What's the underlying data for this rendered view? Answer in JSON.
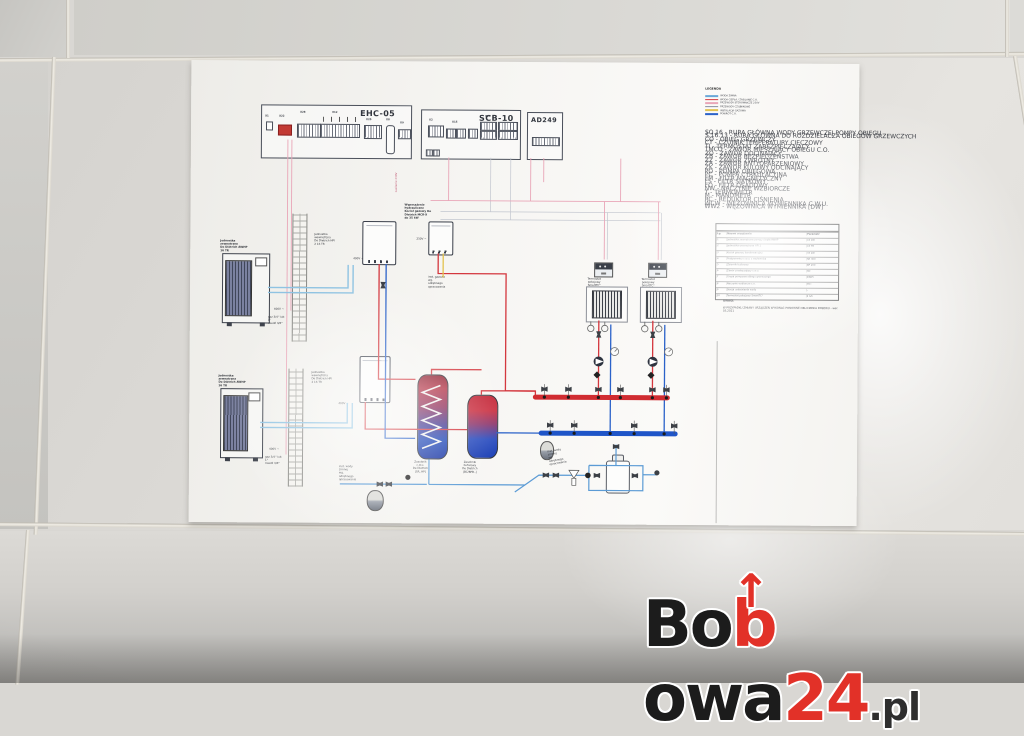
{
  "watermark": {
    "bo": "Bo",
    "b_arrow": "b",
    "arrow": "↑",
    "owa": "owa",
    "num": "24",
    "tld": ".pl"
  },
  "colors": {
    "logo_black": "#1c1c1c",
    "logo_red": "#e23128",
    "paper": "#f6f5f2",
    "tile": "#d9d7d3",
    "pipe_hot": "#d4373e",
    "pipe_cold": "#2b62c9",
    "pipe_refrigerant": "#8fc3e2",
    "wire_control": "#e9a6b8",
    "gas_line": "#e3c24f",
    "manifold_hot": "#d02c31",
    "manifold_cold": "#1f55c8"
  },
  "boards": {
    "ehc": {
      "title": "EHC-05",
      "x1": "X1",
      "x22": "X22",
      "x28": "X28",
      "x12": "X12",
      "x25": "X25",
      "x8": "X8",
      "x9": "X9"
    },
    "scb": {
      "title": "SCB-10",
      "x2": "X2",
      "x15": "X15",
      "x14": "X14"
    },
    "ad": {
      "title": "AD249"
    }
  },
  "devices": {
    "outdoor1": "Jednostka zewnętrzna\nDe Dietrich AWHP 16 TR",
    "outdoor2": "Jednostka zewnętrzna\nDe Dietrich AWHP 16 TR",
    "indoor1": "Jednostka wewnętrzna\nDe Dietrich HPI 2 16 TR",
    "indoor2": "Jednostka wewnętrzna\nDe Dietrich HPI 2 16 TR",
    "boiler": "Wyposażenie hydrauliczne\nKocioł gazowy De Dietrich MCR-X\ndo 35 kW",
    "dhw_tank": "Zasobnik c.w.u.\nDe Dietrich [SR..HP]",
    "buffer_tank": "Zasobnik buforowy\nDe Dietrich [BC/BPB..]",
    "thermostat1": "Termostat pokojowy\nSmartTC°",
    "thermostat2": "Termostat pokojowy\nSmartTC°",
    "v400": "400V ~",
    "v230": "230V ~",
    "gas_note": "inst. gazowa\nwg. odrębnego\nopracowania",
    "cold_note": "inst. wody zimnej\nwg. odrębnego\nopracowania",
    "pipe_note": "gaz 3/4'' lub 1''\nmiedź 3/8''",
    "power_note": "zasilanie 230V"
  },
  "legend": {
    "title": "LEGENDA",
    "keys": [
      {
        "css": "background:#6aa8d8",
        "label": "WODA ZIMNA"
      },
      {
        "css": "background:#d4373e",
        "label": "WODA CIEPŁA / ZASILANIE C.O."
      },
      {
        "css": "background:#e9a6b8",
        "label": "PRZEWODY STEROWNICZE 230V"
      },
      {
        "css": "background:#8a8fa0",
        "label": "PRZEWODY CZUJNIKOWE"
      },
      {
        "css": "background:#e3c24f",
        "label": "INSTALACJA GAZOWA"
      },
      {
        "css": "background:#2b62c9",
        "label": "POWRÓT C.O."
      }
    ],
    "entries": [
      "SO.16 - RURA GŁÓWNA WODY GRZEWCZEJ POMPY OBIEGU",
      "S.16.13 - RURA GŁÓWNA DO ROZDZIELACZA OBIEGÓW GRZEWCZYCH",
      "CO - OBIEG GRZEWCZY",
      "CT - CZUJNIK TEMPERATURY CIECZOWY",
      "TI - TERMOSTAT ZABEZPIECZAJĄCY",
      "TMCO - ZAWÓR MIESZAJĄCY OBIEGU C.O.",
      "ZO - ZAWÓR ODCINAJĄCY",
      "ZB - ZAWÓR BEZPIECZEŃSTWA",
      "ZZ - ZAWÓR ZWROTNY",
      "ZA - ZAWÓR ANTYOPARZENIOWY",
      "ZK - ZAWÓR KULOWY ODCINAJĄCY",
      "PO - POMPA OBIEGOWA",
      "PC - POMPA CYRKULACYJNA",
      "FM - FILTR MAGNETYCZNY",
      "FS - FILTR SIATKOWY",
      "FO - FILTR OSADOWY",
      "NW - NACZYNIE WZBIORCZE",
      "T - TERMOMETR",
      "M - MANOMETR",
      "RC - REDUKTOR CIŚNIENIA",
      "WCW - WĘŻOWNICA WYMIENNIKA C.W.U.",
      "WW2 - WĘŻOWNICA WYMIENNIKA [DW]"
    ]
  },
  "table": {
    "caption": "ZESTAWIENIE GŁÓWNYCH URZĄDZEŃ",
    "headers": [
      "Lp.",
      "Nazwa urządzenia",
      "Parametr"
    ],
    "rows": [
      {
        "lp": "1",
        "name": "Jednostka zewnętrzna pompy ciepła AWHP",
        "val": "16 kW"
      },
      {
        "lp": "2",
        "name": "Jednostka wewnętrzna HPI 2",
        "val": "16 TR"
      },
      {
        "lp": "3",
        "name": "Kocioł gazowy kondensacyjny",
        "val": "35 kW"
      },
      {
        "lp": "4",
        "name": "Podgrzewacz c.w.u. z wężownicą",
        "val": "SR 300"
      },
      {
        "lp": "5",
        "name": "Zbiornik buforowy",
        "val": "BP 200"
      },
      {
        "lp": "6",
        "name": "Zawór przełączający c.w.u.",
        "val": "3D"
      },
      {
        "lp": "7",
        "name": "Grupa pompowa obiegu grzewczego",
        "val": "DN25"
      },
      {
        "lp": "8",
        "name": "Naczynie wzbiorcze c.o.",
        "val": "35 l"
      },
      {
        "lp": "9",
        "name": "Stacja uzdatniania wody",
        "val": "-"
      },
      {
        "lp": "10",
        "name": "Termostat pokojowy SmartTC°",
        "val": "2 szt."
      }
    ]
  },
  "notes": {
    "title": "UWAGI:",
    "line": "W PRZYPADKU ZMIANY URZĄDZEŃ WYKONAĆ PONOWNE OBLICZENIA DOBORU - wer. 03.2021"
  }
}
